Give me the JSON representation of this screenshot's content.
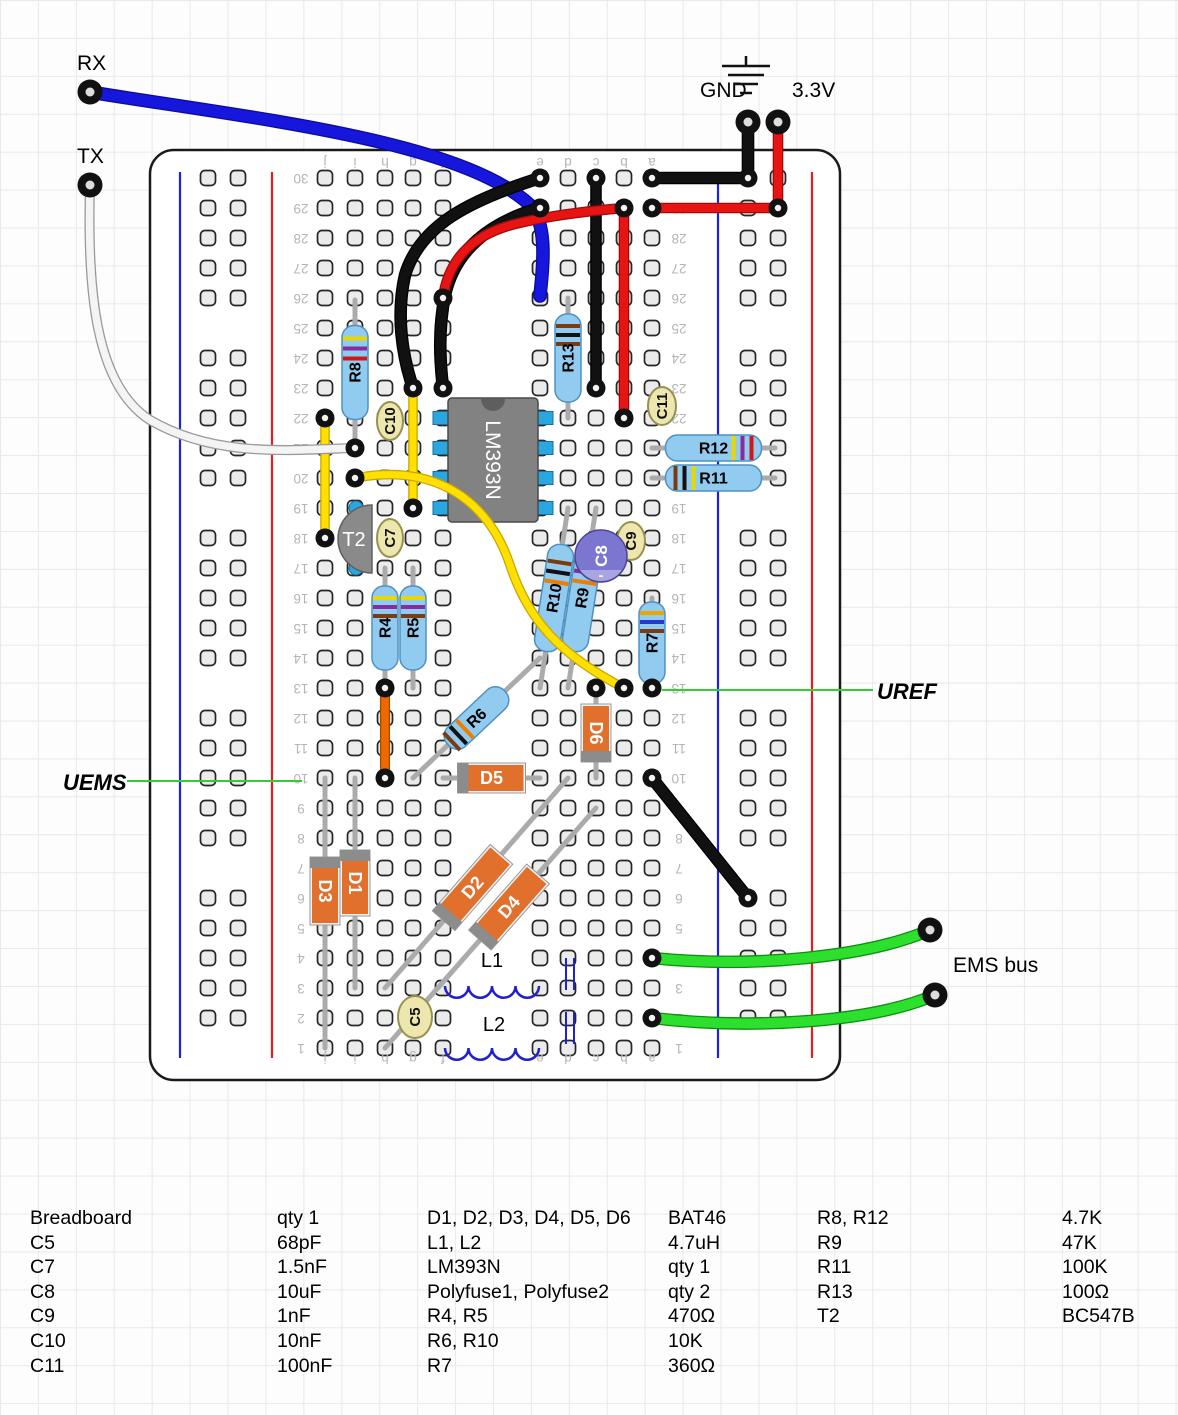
{
  "annotations": {
    "rx": "RX",
    "tx": "TX",
    "gnd": "GND",
    "v33": "3.3V",
    "uref": "UREF",
    "uems": "UEMS",
    "ems_bus": "EMS bus"
  },
  "board": {
    "column_letters": [
      "j",
      "i",
      "h",
      "g",
      "f",
      "e",
      "d",
      "c",
      "b",
      "a"
    ],
    "row_min": 1,
    "row_max": 30
  },
  "wire_colors": {
    "black": "#111111",
    "red": "#e81313",
    "blue": "#1616dc",
    "yellow": "#ffe000",
    "orange": "#ee6a00",
    "white": "#f4f4f4",
    "green": "#2ee02e",
    "callout_green": "#33cc33"
  },
  "components": {
    "ic": {
      "label": "LM393N"
    },
    "transistor": {
      "label": "T2"
    },
    "resistors": [
      {
        "id": "R4",
        "label": "R4",
        "bands": [
          "#e6d800",
          "#8a2b9e",
          "#7a3b10"
        ]
      },
      {
        "id": "R5",
        "label": "R5",
        "bands": [
          "#e6d800",
          "#8a2b9e",
          "#7a3b10"
        ]
      },
      {
        "id": "R6",
        "label": "R6",
        "bands": [
          "#7a3b10",
          "#111111",
          "#ef7d00"
        ]
      },
      {
        "id": "R7",
        "label": "R7",
        "bands": [
          "#efa400",
          "#2438cf",
          "#7a3b10"
        ]
      },
      {
        "id": "R8",
        "label": "R8",
        "bands": [
          "#e6d800",
          "#8a2b9e",
          "#d31616"
        ]
      },
      {
        "id": "R9",
        "label": "R9",
        "bands": [
          "#e6d800",
          "#8a2b9e",
          "#ef7d00"
        ]
      },
      {
        "id": "R10",
        "label": "R10",
        "bands": [
          "#7a3b10",
          "#111111",
          "#ef7d00"
        ]
      },
      {
        "id": "R11",
        "label": "R11",
        "bands": [
          "#7a3b10",
          "#111111",
          "#e6d800"
        ]
      },
      {
        "id": "R12",
        "label": "R12",
        "bands": [
          "#e6d800",
          "#8a2b9e",
          "#d31616"
        ]
      },
      {
        "id": "R13",
        "label": "R13",
        "bands": [
          "#7a3b10",
          "#111111",
          "#7a3b10"
        ]
      }
    ],
    "capacitors": [
      {
        "id": "C5",
        "label": "C5"
      },
      {
        "id": "C7",
        "label": "C7"
      },
      {
        "id": "C9",
        "label": "C9"
      },
      {
        "id": "C10",
        "label": "C10"
      },
      {
        "id": "C11",
        "label": "C11"
      }
    ],
    "electrolytic": {
      "id": "C8",
      "label": "C8",
      "polarity_mark": "-"
    },
    "diodes": [
      {
        "id": "D1",
        "label": "D1"
      },
      {
        "id": "D2",
        "label": "D2"
      },
      {
        "id": "D3",
        "label": "D3"
      },
      {
        "id": "D4",
        "label": "D4"
      },
      {
        "id": "D5",
        "label": "D5"
      },
      {
        "id": "D6",
        "label": "D6"
      }
    ],
    "inductors": [
      {
        "id": "L1",
        "label": "L1"
      },
      {
        "id": "L2",
        "label": "L2"
      }
    ]
  },
  "parts_list": {
    "columns": [
      {
        "rows": [
          {
            "name": "Breadboard",
            "value": "qty 1"
          },
          {
            "name": "C5",
            "value": "68pF"
          },
          {
            "name": "C7",
            "value": "1.5nF"
          },
          {
            "name": "C8",
            "value": "10uF"
          },
          {
            "name": "C9",
            "value": "1nF"
          },
          {
            "name": "C10",
            "value": "10nF"
          },
          {
            "name": "C11",
            "value": "100nF"
          }
        ]
      },
      {
        "rows": [
          {
            "name": "D1, D2, D3, D4, D5, D6",
            "value": "BAT46"
          },
          {
            "name": "L1, L2",
            "value": "4.7uH"
          },
          {
            "name": "LM393N",
            "value": "qty 1"
          },
          {
            "name": "Polyfuse1, Polyfuse2",
            "value": "qty 2"
          },
          {
            "name": "R4, R5",
            "value": "470Ω"
          },
          {
            "name": "R6, R10",
            "value": "10K"
          },
          {
            "name": "R7",
            "value": "360Ω"
          }
        ]
      },
      {
        "rows": [
          {
            "name": "R8, R12",
            "value": "4.7K"
          },
          {
            "name": "R9",
            "value": "47K"
          },
          {
            "name": "R11",
            "value": "100K"
          },
          {
            "name": "R13",
            "value": "100Ω"
          },
          {
            "name": "T2",
            "value": "BC547B"
          }
        ]
      }
    ]
  }
}
